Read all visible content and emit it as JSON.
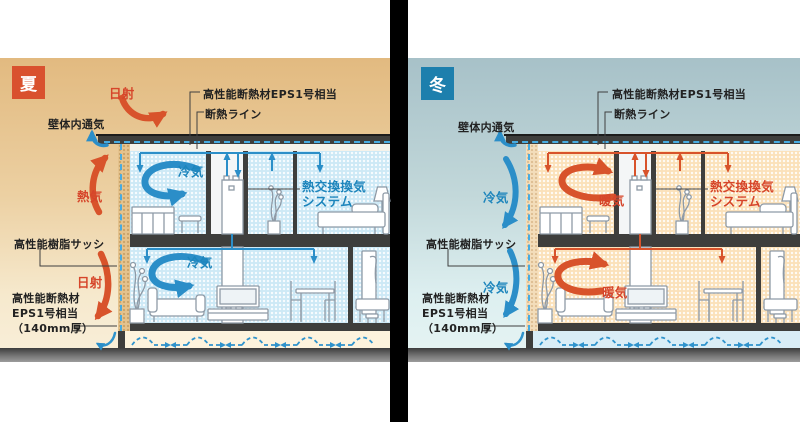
{
  "diagram": {
    "type": "house-insulation-ventilation-cross-section",
    "shared_colors": {
      "insulation_dash_line": "#47abe0",
      "structure_dark": "#3e3e3c",
      "cool_flow": "#2b8ec8",
      "warm_flow": "#d8532b"
    }
  },
  "panels": {
    "summer": {
      "badge": "夏",
      "colors": {
        "badge_bg": "#d9512e",
        "sky_top": "#e2ba80",
        "sky_bottom": "#f9efda",
        "room_fill": "#cde9f6"
      },
      "labels": {
        "solar_top": "日射",
        "wall_cavity_vent": "壁体内通気",
        "hot_air": "熱気",
        "resin_sash": "高性能樹脂サッシ",
        "solar_bottom": "日射",
        "wall_insulation_1": "高性能断熱材",
        "wall_insulation_2": "EPS1号相当",
        "wall_insulation_3": "（140mm厚）",
        "roof_insulation": "高性能断熱材EPS1号相当",
        "insulation_line": "断熱ライン",
        "cool_air_upper": "冷気",
        "heat_exchange_1": "熱交換換気",
        "heat_exchange_2": "システム",
        "cool_air_lower": "冷気"
      }
    },
    "winter": {
      "badge": "冬",
      "colors": {
        "badge_bg": "#1d7fad",
        "sky_top": "#a7c1c8",
        "sky_bottom": "#e6f4f3",
        "room_fill": "#fbe1ba"
      },
      "labels": {
        "wall_cavity_vent": "壁体内通気",
        "cold_air_upper": "冷気",
        "resin_sash": "高性能樹脂サッシ",
        "cold_air_lower": "冷気",
        "wall_insulation_1": "高性能断熱材",
        "wall_insulation_2": "EPS1号相当",
        "wall_insulation_3": "（140mm厚）",
        "roof_insulation": "高性能断熱材EPS1号相当",
        "insulation_line": "断熱ライン",
        "warm_air_upper": "暖気",
        "heat_exchange_1": "熱交換換気",
        "heat_exchange_2": "システム",
        "warm_air_lower": "暖気"
      }
    }
  }
}
